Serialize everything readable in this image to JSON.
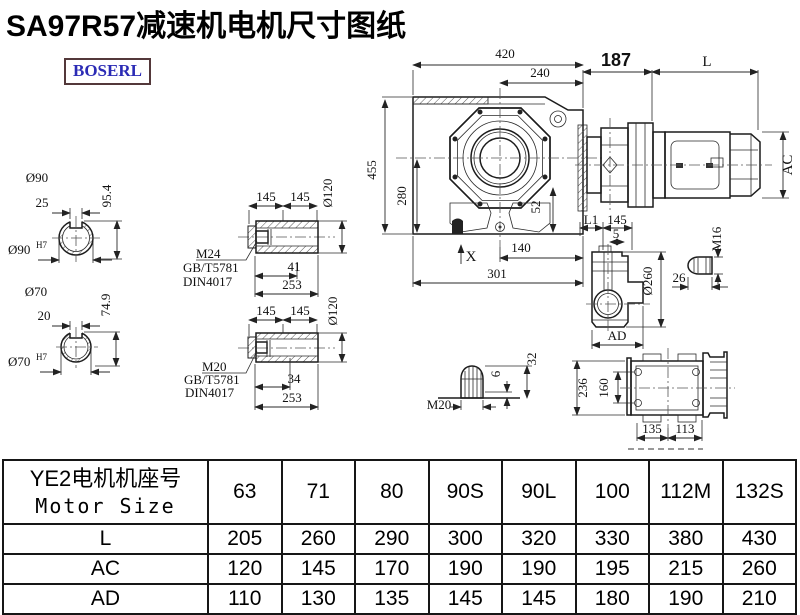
{
  "title": "SA97R57减速机电机尺寸图纸",
  "logo": "BOSERL",
  "front_view": {
    "width_top": "420",
    "width_flange": "240",
    "height_total": "455",
    "height_center": "280",
    "dim_52": "52",
    "dim_140": "140",
    "dim_301": "301",
    "mark_x": "X"
  },
  "motor_view": {
    "dim_187": "187",
    "dim_l": "L",
    "dim_ac": "AC"
  },
  "shaft_90": {
    "label_dia": "Ø90",
    "keyway_width": "25",
    "height": "95.4",
    "bore_dia": "Ø90",
    "bore_tol": "H7"
  },
  "shaft_70": {
    "label_dia": "Ø70",
    "keyway_width": "20",
    "height": "74.9",
    "bore_dia": "Ø70",
    "bore_tol": "H7"
  },
  "sleeve_m24": {
    "dim_left": "145",
    "dim_right": "145",
    "dia": "Ø120",
    "bolt": "M24",
    "std_gb": "GB/T5781",
    "std_din": "DIN4017",
    "dim_bolt": "41",
    "length": "253"
  },
  "sleeve_m20": {
    "dim_left": "145",
    "dim_right": "145",
    "dia": "Ø120",
    "bolt": "M20",
    "std_gb": "GB/T5781",
    "std_din": "DIN4017",
    "dim_bolt": "34",
    "length": "253"
  },
  "side_view": {
    "dim_l1": "L1",
    "dim_145": "145",
    "dim_5": "5",
    "dia_boss": "Ø260",
    "dim_ad": "AD"
  },
  "bolt_m16": {
    "thread": "M16",
    "length": "26"
  },
  "bolt_m20": {
    "thread": "M20",
    "dim_6": "6",
    "dim_32": "32"
  },
  "back_view": {
    "height": "236",
    "bolt_pitch": "160",
    "dim_135": "135",
    "dim_113": "113"
  },
  "table": {
    "header_cn": "YE2电机机座号",
    "header_en": "Motor Size",
    "sizes": [
      "63",
      "71",
      "80",
      "90S",
      "90L",
      "100",
      "112M",
      "132S"
    ],
    "rows": [
      {
        "label": "L",
        "values": [
          "205",
          "260",
          "290",
          "300",
          "320",
          "330",
          "380",
          "430"
        ]
      },
      {
        "label": "AC",
        "values": [
          "120",
          "145",
          "170",
          "190",
          "190",
          "195",
          "215",
          "260"
        ]
      },
      {
        "label": "AD",
        "values": [
          "110",
          "130",
          "135",
          "145",
          "145",
          "180",
          "190",
          "210"
        ]
      }
    ]
  }
}
